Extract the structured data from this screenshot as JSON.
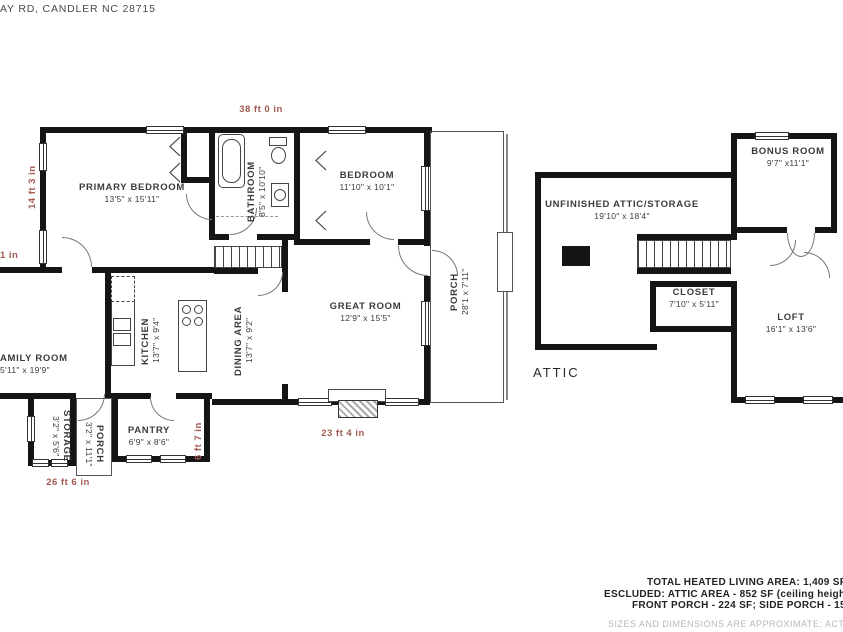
{
  "address": "AY RD, CANDLER NC 28715",
  "colors": {
    "wall": "#151515",
    "dimension_text": "#a05a50",
    "room_text": "#3b3b3b",
    "disclaimer_text": "#b8b8b8"
  },
  "main_floor": {
    "rooms": {
      "primary_bedroom": {
        "name": "PRIMARY BEDROOM",
        "dims": "13'5\" x 15'11\""
      },
      "bathroom": {
        "name": "BATHROOM",
        "dims": "8'5\" x 10'10\""
      },
      "bedroom": {
        "name": "BEDROOM",
        "dims": "11'10\" x 10'1\""
      },
      "porch_side": {
        "name": "PORCH",
        "dims": "28'1 x 7'11\""
      },
      "kitchen": {
        "name": "KITCHEN",
        "dims": "13'7\" x 9'4\""
      },
      "dining": {
        "name": "DINING AREA",
        "dims": "13'7\" x 9'2\""
      },
      "great_room": {
        "name": "GREAT ROOM",
        "dims": "12'9\" x 15'5\""
      },
      "family_room": {
        "name": "AMILY ROOM",
        "dims": "5'11\" x 19'9\""
      },
      "storage": {
        "name": "STORAGE",
        "dims": "3'2\" x 5'6\""
      },
      "porch_small": {
        "name": "PORCH",
        "dims": "3'2\" x 11'1\""
      },
      "pantry": {
        "name": "PANTRY",
        "dims": "6'9\" x 8'6\""
      }
    },
    "dimensions": {
      "top": "38 ft 0 in",
      "left_upper": "14 ft 3 in",
      "left_partial": "1 in",
      "bottom_right": "23 ft 4 in",
      "pantry_side": "6 ft 7 in",
      "bottom_left": "26 ft 6 in"
    }
  },
  "attic": {
    "label": "ATTIC",
    "rooms": {
      "unfinished": {
        "name": "UNFINISHED ATTIC/STORAGE",
        "dims": "19'10\" x 18'4\""
      },
      "bonus": {
        "name": "BONUS ROOM",
        "dims": "9'7\" x11'1\""
      },
      "closet": {
        "name": "CLOSET",
        "dims": "7'10\" x 5'11\""
      },
      "loft": {
        "name": "LOFT",
        "dims": "16'1\" x 13'6\""
      }
    }
  },
  "summary": {
    "line1": "TOTAL HEATED LIVING AREA: 1,409 SF",
    "line2": "ESCLUDED: ATTIC AREA - 852 SF (ceiling heigh",
    "line3": "FRONT PORCH - 224 SF; SIDE PORCH - 15",
    "disclaimer": "SIZES AND DIMENSIONS ARE APPROXIMATE; ACTUAL M"
  }
}
